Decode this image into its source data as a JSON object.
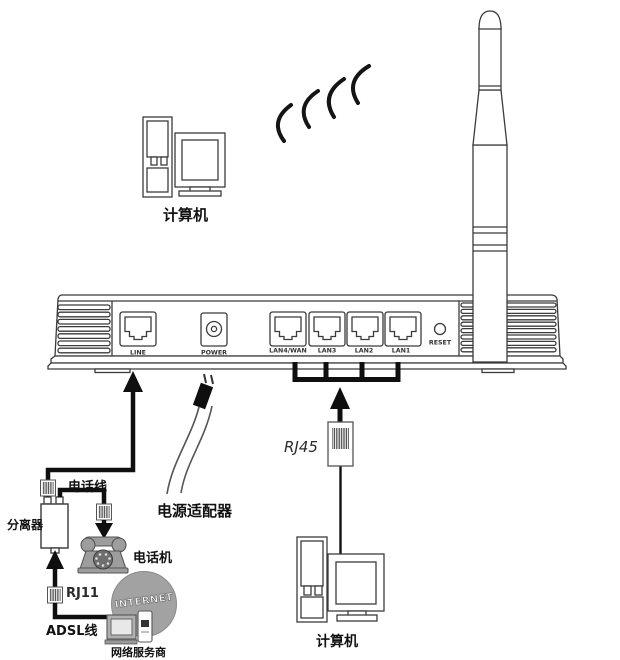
{
  "diagram": {
    "title": "ADSL 无线路由器连接示意图",
    "labels": {
      "wireless_computer": "计算机",
      "wired_computer": "计算机",
      "phone_line": "电话线",
      "splitter": "分离器",
      "telephone": "电话机",
      "rj11": "RJ11",
      "adsl_line": "ADSL线",
      "isp": "网络服务商",
      "internet": "INTERNET",
      "power_adapter": "电源适配器",
      "rj45": "RJ45"
    },
    "router_ports": {
      "line": "LINE",
      "power": "POWER",
      "lan4_wan": "LAN4/WAN",
      "lan3": "LAN3",
      "lan2": "LAN2",
      "lan1": "LAN1",
      "reset": "RESET"
    },
    "colors": {
      "background": "#ffffff",
      "line_art": "#3b3b3b",
      "wire": "#0f0f0f",
      "device_gray": "#9d9d9d",
      "globe_gray": "#a2a2a2"
    }
  }
}
